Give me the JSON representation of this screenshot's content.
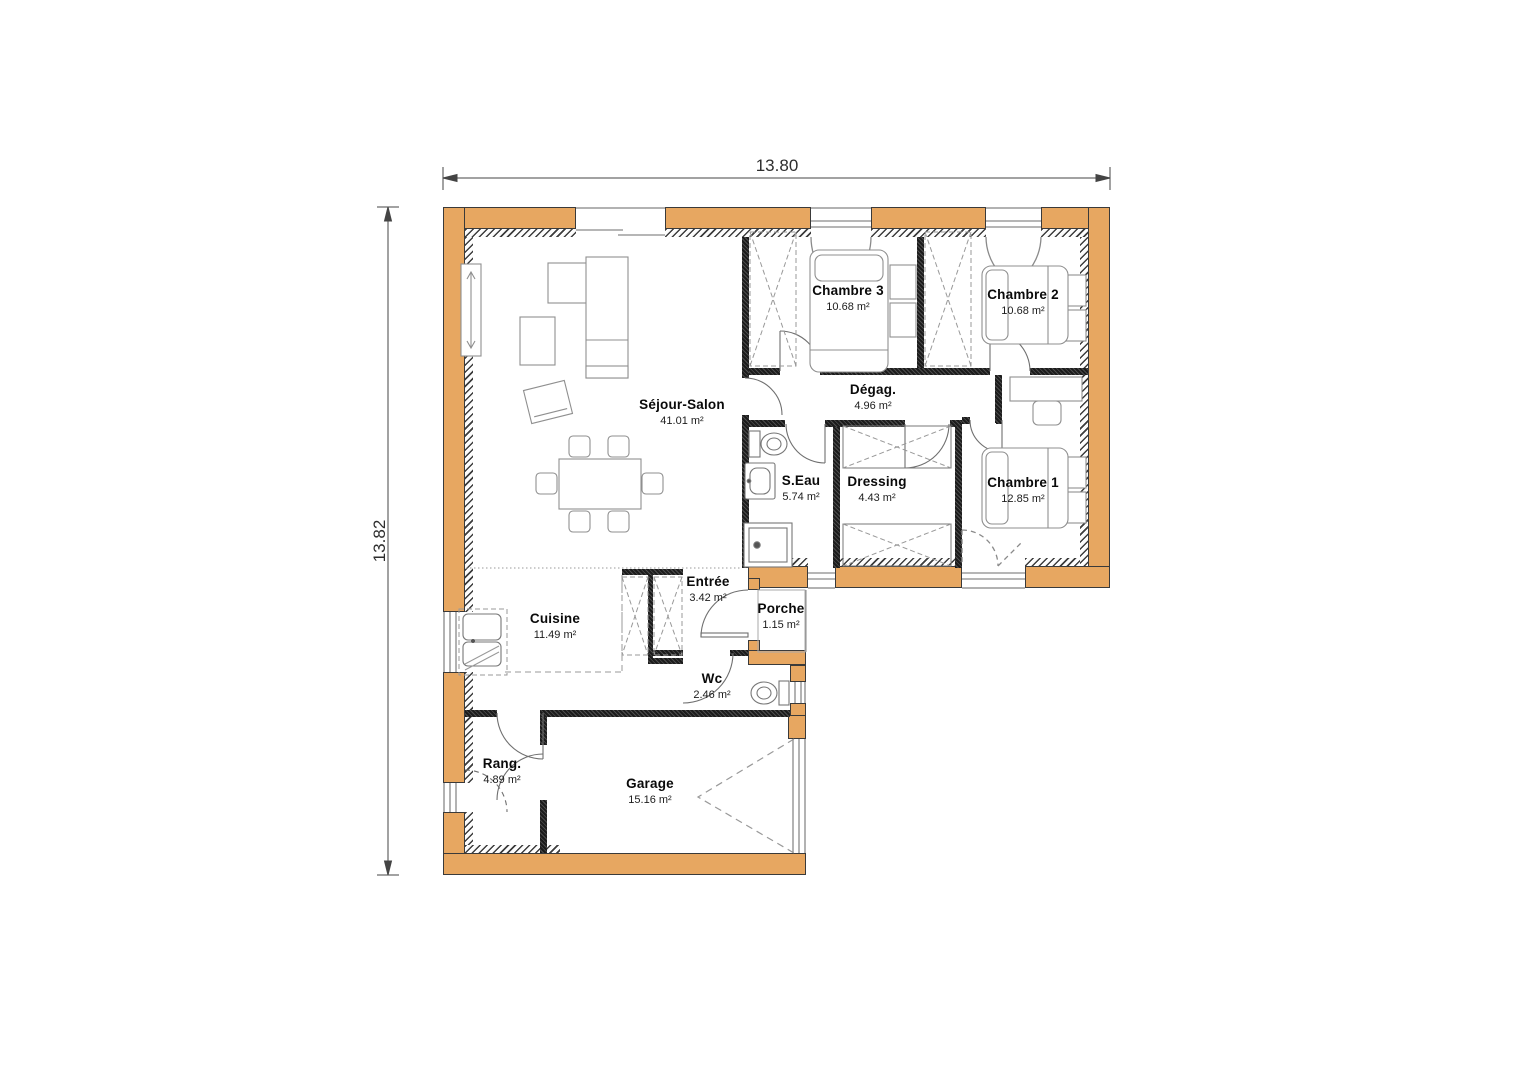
{
  "dimensions": {
    "width_label": "13.80",
    "height_label": "13.82"
  },
  "rooms": [
    {
      "id": "sejour",
      "name": "Séjour-Salon",
      "area": "41.01 m²"
    },
    {
      "id": "chambre3",
      "name": "Chambre 3",
      "area": "10.68 m²"
    },
    {
      "id": "chambre2",
      "name": "Chambre 2",
      "area": "10.68 m²"
    },
    {
      "id": "chambre1",
      "name": "Chambre 1",
      "area": "12.85 m²"
    },
    {
      "id": "degag",
      "name": "Dégag.",
      "area": "4.96 m²"
    },
    {
      "id": "seau",
      "name": "S.Eau",
      "area": "5.74 m²"
    },
    {
      "id": "dressing",
      "name": "Dressing",
      "area": "4.43 m²"
    },
    {
      "id": "entree",
      "name": "Entrée",
      "area": "3.42 m²"
    },
    {
      "id": "porche",
      "name": "Porche",
      "area": "1.15 m²"
    },
    {
      "id": "cuisine",
      "name": "Cuisine",
      "area": "11.49 m²"
    },
    {
      "id": "wc",
      "name": "Wc",
      "area": "2.46 m²"
    },
    {
      "id": "rang",
      "name": "Rang.",
      "area": "4.89 m²"
    },
    {
      "id": "garage",
      "name": "Garage",
      "area": "15.16 m²"
    }
  ],
  "colors": {
    "exterior_wall_fill": "#E7A761",
    "wall_outline": "#3A3A3A",
    "partition_wall": "#2E2E2E",
    "furniture_stroke": "#8F8F8F",
    "dimension_line": "#444444",
    "background": "#FFFFFF"
  }
}
